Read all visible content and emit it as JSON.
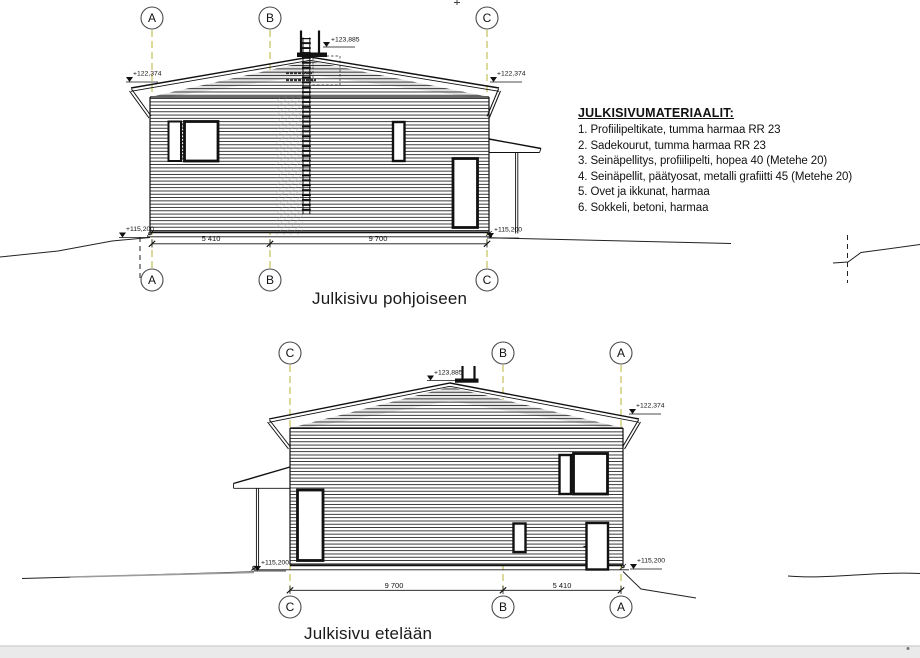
{
  "materials": {
    "title": "JULKISIVUMATERIAALIT:",
    "items": [
      "1. Profiilipeltikate, tumma harmaa RR 23",
      "2. Sadekourut, tumma harmaa RR 23",
      "3. Seinäpellitys, profiilipelti, hopea 40 (Metehe 20)",
      "4. Seinäpellit, päätyosat, metalli grafiitti 45 (Metehe 20)",
      "5. Ovet ja ikkunat, harmaa",
      "6. Sokkeli, betoni, harmaa"
    ]
  },
  "north": {
    "title": "Julkisivu pohjoiseen",
    "grid": [
      "A",
      "B",
      "C"
    ],
    "levels": {
      "ridge": "+123,885",
      "eave_left": "+122,374",
      "eave_right": "+122,374",
      "floor_left": "+115,200",
      "floor_right": "+115,200"
    },
    "dims": {
      "ab": "5 410",
      "bc": "9 700"
    }
  },
  "south": {
    "title": "Julkisivu etelään",
    "grid": [
      "C",
      "B",
      "A"
    ],
    "levels": {
      "ridge": "+123,885",
      "eave_right": "+122,374",
      "floor_left": "+115,200",
      "floor_right": "+115,200"
    },
    "dims": {
      "cb": "9 700",
      "ba": "5 410"
    }
  },
  "colors": {
    "grid_line": "#b8b434",
    "line": "#1a1a1a",
    "gable_shade": "#cfcfcf",
    "footer_band": "#eaeaea"
  }
}
